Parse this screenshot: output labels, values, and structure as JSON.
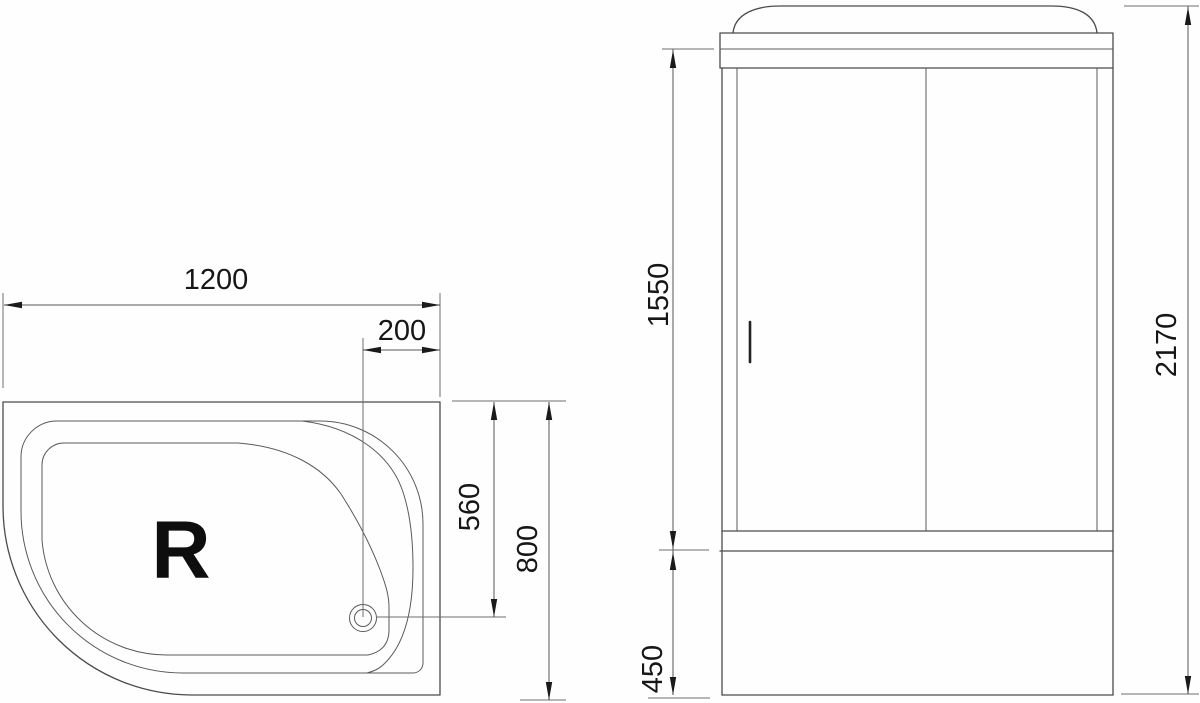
{
  "drawing": {
    "kind": "shower-cabin-technical-drawing",
    "colors": {
      "background": "#fefefe",
      "object_line": "#4b4b4b",
      "dimension_line": "#555555",
      "text": "#161616"
    },
    "plan_view": {
      "orientation_label": "R",
      "dimensions": {
        "overall_width": "1200",
        "drain_offset_from_right": "200",
        "drain_offset_from_back": "560",
        "overall_depth": "800"
      }
    },
    "front_view": {
      "dimensions": {
        "door_section_height": "1550",
        "overall_height": "2170",
        "base_height": "450"
      }
    }
  }
}
